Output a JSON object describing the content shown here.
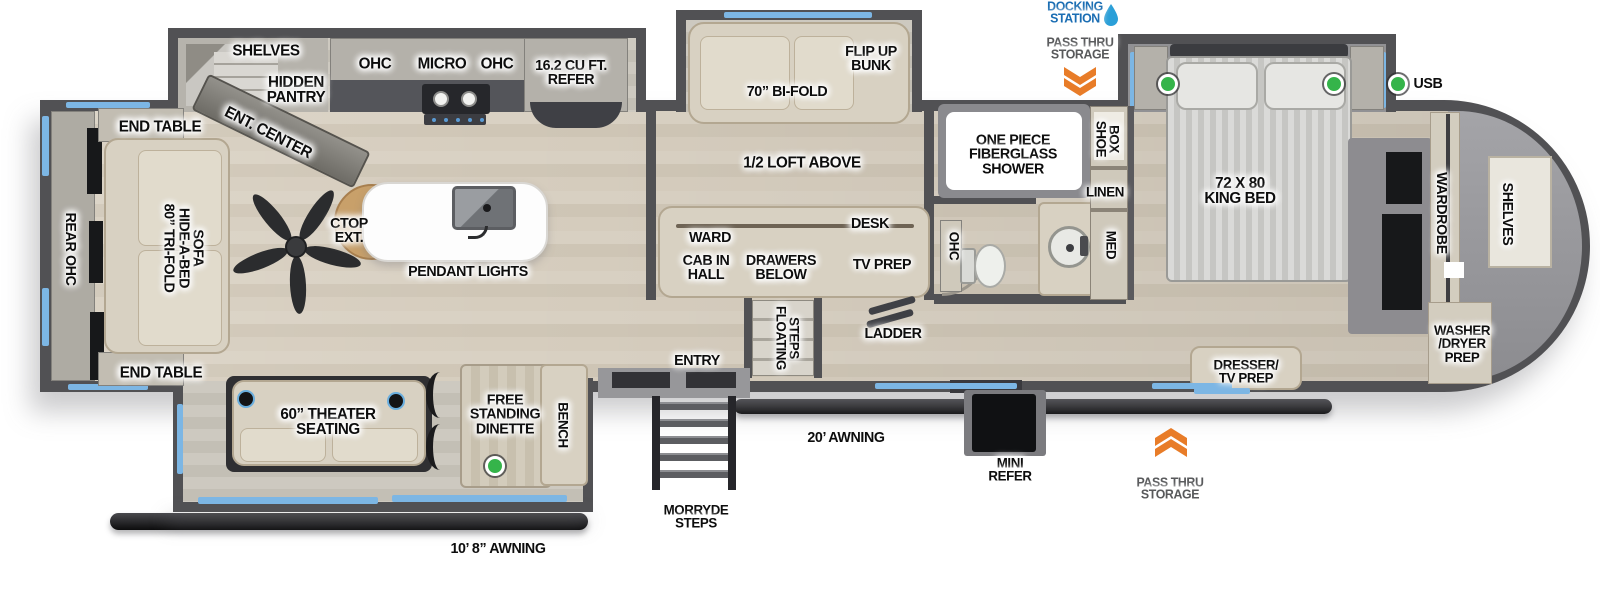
{
  "title": "Fifth wheel RV floorplan",
  "colors": {
    "accent_blue": "#7cb6e4",
    "orange": "#e87c28",
    "green": "#35b44a",
    "blue_text": "#1a6db3",
    "gray_text": "#58595b",
    "wall_gray": "#515154",
    "floor_beige": "#d4ccbd"
  },
  "legend": {
    "usb": "USB"
  },
  "labels": [
    {
      "name": "rear-ohc",
      "text": "REAR OHC",
      "x": 70,
      "y": 249,
      "r": 90,
      "s": 15
    },
    {
      "name": "end-table-top",
      "text": "END TABLE",
      "x": 160,
      "y": 127,
      "s": 16
    },
    {
      "name": "hide-a-bed-sofa",
      "text": "80” TRI-FOLD\nHIDE-A-BED\nSOFA",
      "x": 183,
      "y": 248,
      "r": 90,
      "s": 15
    },
    {
      "name": "end-table-bottom",
      "text": "END TABLE",
      "x": 161,
      "y": 373,
      "s": 16
    },
    {
      "name": "shelves-kitchen",
      "text": "SHELVES",
      "x": 266,
      "y": 51,
      "s": 16
    },
    {
      "name": "hidden-pantry",
      "text": "HIDDEN\nPANTRY",
      "x": 296,
      "y": 90,
      "s": 16
    },
    {
      "name": "ent-center",
      "text": "ENT. CENTER",
      "x": 268,
      "y": 133,
      "r": 27,
      "s": 16
    },
    {
      "name": "ohc-kitchen-left",
      "text": "OHC",
      "x": 375,
      "y": 64,
      "s": 16
    },
    {
      "name": "micro",
      "text": "MICRO",
      "x": 442,
      "y": 64,
      "s": 16
    },
    {
      "name": "ohc-kitchen-right",
      "text": "OHC",
      "x": 497,
      "y": 64,
      "s": 16
    },
    {
      "name": "refer",
      "text": "16.2 CU FT.\nREFER",
      "x": 571,
      "y": 73,
      "s": 15
    },
    {
      "name": "ctop-ext",
      "text": "CTOP\nEXT.",
      "x": 349,
      "y": 231,
      "s": 15
    },
    {
      "name": "pendant-lights",
      "text": "PENDANT LIGHTS",
      "x": 468,
      "y": 272,
      "s": 15
    },
    {
      "name": "flip-up-bunk",
      "text": "FLIP UP\nBUNK",
      "x": 871,
      "y": 59,
      "s": 15
    },
    {
      "name": "bi-fold",
      "text": "70” BI-FOLD",
      "x": 787,
      "y": 92,
      "s": 15
    },
    {
      "name": "half-loft",
      "text": "1/2 LOFT ABOVE",
      "x": 802,
      "y": 163,
      "s": 16
    },
    {
      "name": "desk",
      "text": "DESK",
      "x": 870,
      "y": 224,
      "s": 15
    },
    {
      "name": "ward",
      "text": "WARD",
      "x": 710,
      "y": 238,
      "s": 15
    },
    {
      "name": "cab-in-hall",
      "text": "CAB IN\nHALL",
      "x": 706,
      "y": 268,
      "s": 15
    },
    {
      "name": "drawers-below",
      "text": "DRAWERS\nBELOW",
      "x": 781,
      "y": 268,
      "s": 15
    },
    {
      "name": "tv-prep-bunk",
      "text": "TV PREP",
      "x": 882,
      "y": 265,
      "s": 15
    },
    {
      "name": "floating-steps",
      "text": "FLOATING\nSTEPS",
      "x": 787,
      "y": 338,
      "r": 90,
      "s": 14
    },
    {
      "name": "entry",
      "text": "ENTRY",
      "x": 697,
      "y": 361,
      "s": 15
    },
    {
      "name": "ladder",
      "text": "LADDER",
      "x": 893,
      "y": 334,
      "s": 15
    },
    {
      "name": "shower",
      "text": "ONE PIECE\nFIBERGLASS\nSHOWER",
      "x": 1013,
      "y": 155,
      "s": 15
    },
    {
      "name": "shoe-box",
      "text": "SHOE\nBOX",
      "x": 1107,
      "y": 139,
      "r": 90,
      "s": 14
    },
    {
      "name": "linen",
      "text": "LINEN",
      "x": 1105,
      "y": 192,
      "s": 14
    },
    {
      "name": "ohc-bath",
      "text": "OHC",
      "x": 954,
      "y": 246,
      "r": 90,
      "s": 14
    },
    {
      "name": "med",
      "text": "MED",
      "x": 1111,
      "y": 245,
      "r": 90,
      "s": 14
    },
    {
      "name": "king-bed",
      "text": "72 X 80\nKING BED",
      "x": 1240,
      "y": 191,
      "s": 16
    },
    {
      "name": "wardrobe",
      "text": "WARDROBE",
      "x": 1441,
      "y": 213,
      "r": 90,
      "s": 15
    },
    {
      "name": "shelves-front",
      "text": "SHELVES",
      "x": 1507,
      "y": 214,
      "r": 90,
      "s": 15
    },
    {
      "name": "washer-dryer-prep",
      "text": "WASHER\n/DRYER\nPREP",
      "x": 1462,
      "y": 344,
      "s": 14
    },
    {
      "name": "dresser-tv-prep",
      "text": "DRESSER/\nTV PREP",
      "x": 1246,
      "y": 372,
      "s": 14
    },
    {
      "name": "theater-seating",
      "text": "60” THEATER\nSEATING",
      "x": 328,
      "y": 422,
      "s": 16
    },
    {
      "name": "free-standing-dinette",
      "text": "FREE\nSTANDING\nDINETTE",
      "x": 505,
      "y": 415,
      "s": 15
    },
    {
      "name": "bench",
      "text": "BENCH",
      "x": 563,
      "y": 425,
      "r": 90,
      "s": 14
    },
    {
      "name": "docking-station",
      "text": "DOCKING\nSTATION",
      "x": 1075,
      "y": 13,
      "s": 13,
      "c": "#1a6db3"
    },
    {
      "name": "pass-thru-storage-top",
      "text": "PASS THRU\nSTORAGE",
      "x": 1080,
      "y": 49,
      "s": 13,
      "c": "#58595b"
    },
    {
      "name": "usb-legend",
      "text": "USB",
      "x": 1428,
      "y": 84,
      "s": 15
    },
    {
      "name": "morryde-steps",
      "text": "MORRYDE\nSTEPS",
      "x": 696,
      "y": 517,
      "s": 14
    },
    {
      "name": "awning-20",
      "text": "20’ AWNING",
      "x": 846,
      "y": 438,
      "s": 15
    },
    {
      "name": "mini-refer",
      "text": "MINI\nREFER",
      "x": 1010,
      "y": 470,
      "s": 14
    },
    {
      "name": "pass-thru-storage-bottom",
      "text": "PASS THRU\nSTORAGE",
      "x": 1170,
      "y": 489,
      "s": 13,
      "c": "#58595b"
    },
    {
      "name": "awning-10-8",
      "text": "10’ 8” AWNING",
      "x": 498,
      "y": 549,
      "s": 15
    }
  ]
}
